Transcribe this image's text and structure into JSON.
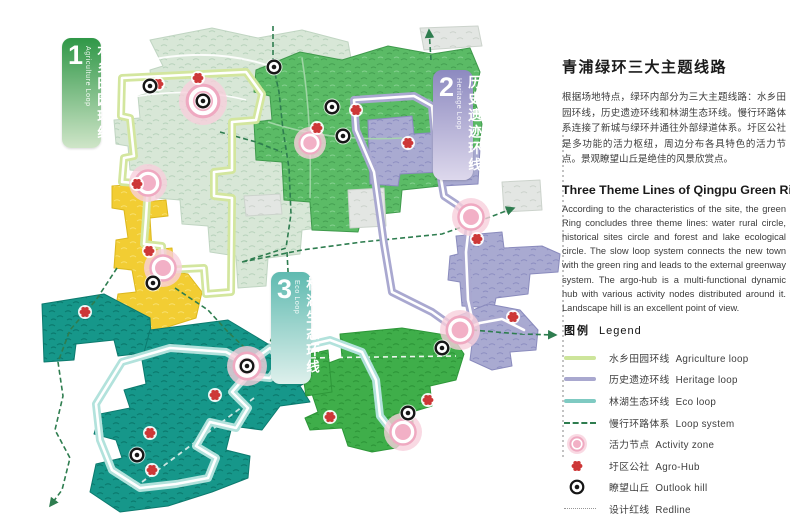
{
  "panel": {
    "title_zh": "青浦绿环三大主题线路",
    "para_zh": "根据场地特点，绿环内部分为三大主题线路：水乡田园环线，历史遗迹环线和林湖生态环线。慢行环路体系连接了新城与绿环并通往外部绿道体系。圩区公社是多功能的活力枢纽，周边分布各具特色的活力节点。景观瞭望山丘是绝佳的风景欣赏点。",
    "title_en": "Three Theme Lines of Qingpu Green Ring",
    "para_en": "According to the characteristics of the site, the green Ring concludes three theme lines: water rural circle, historical sites circle and forest and lake ecological circle. The slow loop system connects the new town with the green ring and leads to the external greenway system. The argo-hub is a multi-functional dynamic hub with various activity nodes distributed around it. Landscape hill is an excellent point of view."
  },
  "legend": {
    "header_zh": "图例",
    "header_en": "Legend",
    "items": [
      {
        "swatch": "line",
        "color": "#cde59b",
        "zh": "水乡田园环线",
        "en": "Agriculture loop"
      },
      {
        "swatch": "line",
        "color": "#a9a8cf",
        "zh": "历史遗迹环线",
        "en": "Heritage loop"
      },
      {
        "swatch": "line",
        "color": "#7fcac2",
        "zh": "林湖生态环线",
        "en": "Eco loop"
      },
      {
        "swatch": "dash",
        "color": "#2e7d4f",
        "zh": "慢行环路体系",
        "en": "Loop system"
      },
      {
        "swatch": "activity",
        "color": "#efa9c1",
        "zh": "活力节点",
        "en": "Activity zone"
      },
      {
        "swatch": "agro",
        "color": "#cd3737",
        "zh": "圩区公社",
        "en": "Agro-Hub"
      },
      {
        "swatch": "outlook",
        "color": "#161616",
        "zh": "瞭望山丘",
        "en": "Outlook hill"
      },
      {
        "swatch": "redline",
        "color": "#979797",
        "zh": "设计红线",
        "en": "Redline"
      }
    ]
  },
  "badges": [
    {
      "num": "1",
      "zh": "水乡田园环线",
      "en": "Agriculture Loop",
      "x": 62,
      "y": 38,
      "w": 39,
      "h": 110,
      "from": "#2f9747",
      "to": "#cfe5c8"
    },
    {
      "num": "2",
      "zh": "历史遗迹环线",
      "en": "Heritage Loop",
      "x": 433,
      "y": 70,
      "w": 40,
      "h": 110,
      "from": "#8d8ac0",
      "to": "#ddd8ec"
    },
    {
      "num": "3",
      "zh": "林湖生态环线",
      "en": "Eco Loop",
      "x": 271,
      "y": 272,
      "w": 40,
      "h": 112,
      "from": "#5fbab0",
      "to": "#def0ec"
    }
  ],
  "map": {
    "regions": [
      {
        "name": "farmland-pale",
        "pattern": "pale",
        "edge": "#c0d5c2",
        "path": "M150,40 L212,28 L258,38 L302,30 L348,42 L352,64 L312,62 L310,80 L346,82 L350,108 L300,104 L298,132 L332,136 L334,162 L306,164 L304,190 L332,192 L334,226 L302,230 L300,254 L268,258 L266,286 L238,288 L236,256 L210,252 L208,226 L182,224 L180,200 L156,198 L154,172 L130,170 L128,146 L116,144 L114,120 L140,118 L138,96 L152,92 L150,70 L163,66 Z"
      },
      {
        "name": "north-forest",
        "pattern": "green",
        "edge": "#3f9a4c",
        "path": "M256,70 L300,52 L342,60 L388,46 L432,54 L470,48 L480,72 L474,98 L482,124 L478,152 L442,156 L440,186 L402,190 L400,212 L362,216 L358,232 L312,230 L310,202 L284,200 L282,162 L256,160 L254,122 L272,120 L270,96 L254,92 Z"
      },
      {
        "name": "gray-urban-1",
        "pattern": "gray",
        "edge": "#ccd3cc",
        "path": "M420,28 L478,26 L482,46 L424,50 Z"
      },
      {
        "name": "gray-urban-2",
        "pattern": "gray",
        "edge": "#ccd3cc",
        "path": "M348,190 L384,188 L386,226 L350,228 Z"
      },
      {
        "name": "gray-urban-3",
        "pattern": "gray",
        "edge": "#ccd3cc",
        "path": "M502,182 L540,180 L542,210 L504,212 Z"
      },
      {
        "name": "gray-urban-4",
        "pattern": "gray",
        "edge": "#ccd3cc",
        "path": "M244,196 L280,194 L282,214 L246,216 Z"
      },
      {
        "name": "heritage-forest-a",
        "pattern": "purple",
        "edge": "#8a8bbd",
        "path": "M368,120 L412,116 L414,134 L442,132 L444,150 L480,148 L478,184 L442,186 L440,172 L400,174 L398,186 L370,184 Z"
      },
      {
        "name": "heritage-forest-b",
        "pattern": "purple",
        "edge": "#8a8bbd",
        "path": "M456,236 L502,232 L504,248 L542,246 L560,254 L558,272 L530,274 L528,294 L496,298 L494,308 L462,306 L460,282 L448,280 L450,256 L458,254 Z"
      },
      {
        "name": "heritage-forest-c",
        "pattern": "purple",
        "edge": "#8a8bbd",
        "path": "M458,316 L488,304 L520,310 L538,330 L536,350 L510,352 L512,366 L492,370 L470,360 L472,344 L456,336 Z"
      },
      {
        "name": "village-yellow",
        "pattern": "yellow",
        "edge": "#dcb81e",
        "path": "M112,186 L142,184 L144,202 L166,200 L168,216 L150,218 L152,250 L172,248 L174,272 L188,274 L202,292 L196,318 L158,330 L128,332 L114,318 L118,294 L136,292 L132,270 L114,268 L116,240 L128,238 L124,210 L112,208 Z"
      },
      {
        "name": "eco-forest-west",
        "pattern": "teal",
        "edge": "#0c7a6e",
        "path": "M42,304 L104,294 L150,318 L152,352 L118,356 L114,340 L76,344 L74,360 L44,362 Z"
      },
      {
        "name": "eco-forest-main",
        "pattern": "teal",
        "edge": "#0c7a6e",
        "path": "M150,330 L228,320 L268,344 L312,354 L326,370 L300,386 L310,402 L280,406 L262,430 L232,426 L226,450 L250,456 L248,478 L212,492 L168,506 L120,512 L90,492 L96,464 L122,458 L116,440 L94,434 L100,414 L130,408 L124,390 L146,384 L142,360 Z"
      },
      {
        "name": "south-forest",
        "pattern": "bgreen",
        "edge": "#2e9739",
        "path": "M340,334 L402,328 L452,336 L464,354 L456,380 L430,386 L432,406 L412,412 L414,432 L396,448 L372,452 L348,446 L342,428 L310,430 L305,418 L318,412 L312,394 L330,390 L326,364 L342,358 Z"
      },
      {
        "name": "south-forest-west-lobe",
        "pattern": "bgreen",
        "edge": "#2e9739",
        "path": "M300,356 L328,350 L332,392 L306,396 Z"
      }
    ],
    "roads": [
      {
        "name": "farm-road-1",
        "path": "M140,62 Q210,46 270,66",
        "color": "#ffffff",
        "width": 2
      },
      {
        "name": "farm-road-2",
        "path": "M128,98 Q190,86 246,100",
        "color": "#ffffff",
        "width": 1.6
      },
      {
        "name": "forest-road-1",
        "path": "M268,122 Q330,142 402,138",
        "color": "#a5d8ab",
        "width": 1.6
      },
      {
        "name": "forest-road-2",
        "path": "M302,58 Q312,120 310,198",
        "color": "#a5d8ab",
        "width": 1.6
      },
      {
        "name": "south-road",
        "path": "M302,358 L456,356",
        "color": "#ffffff",
        "width": 1.6,
        "dash": "5 4"
      },
      {
        "name": "eco-road",
        "path": "M142,482 L254,398",
        "color": "#dff0ec",
        "width": 1.8,
        "dash": "5 4"
      }
    ],
    "loop_system": [
      {
        "name": "slow-loop-north",
        "path": "M273,26 L273,64 L279,92 L283,130 L289,168 L291,214 L286,248 L242,262",
        "arrow": false
      },
      {
        "name": "slow-loop-east",
        "path": "M242,262 L302,250 L362,242 L442,234 L482,220 L514,208",
        "arrow": true
      },
      {
        "name": "slow-loop-branch",
        "path": "M220,132 L256,142 L282,152",
        "arrow": false
      },
      {
        "name": "slow-loop-west",
        "path": "M117,268 L96,300 L70,330 L58,362 L63,396 L55,430 L70,458 L62,490 L50,506",
        "arrow": true
      },
      {
        "name": "slow-loop-center",
        "path": "M175,288 L208,310 L228,332 L244,347",
        "arrow": false
      },
      {
        "name": "slow-loop-mid",
        "path": "M287,252 L289,290 L281,320 L269,344",
        "arrow": false
      },
      {
        "name": "slow-loop-southeast",
        "path": "M472,330 L520,334 L556,335",
        "arrow": true
      },
      {
        "name": "slow-loop-northeast",
        "path": "M431,60 L429,30",
        "arrow": true
      }
    ],
    "loops": [
      {
        "name": "agriculture-loop",
        "color": "#d3e69e",
        "path": "M122,78 L246,72 L262,94 L256,120 L232,122 L232,170 L214,172 L214,196 L232,198 L231,292 L206,294 L204,268 L164,270 L162,246 L144,244 L146,218 L148,184 L122,182 L124,158 L134,156 L130,118 L121,116 Z"
      },
      {
        "name": "heritage-loop",
        "color": "#a9a8d0",
        "path": "M354,100 L414,96 L432,106 L436,150 L444,196 L456,204 L470,216 L466,252 L468,300 L472,318 L460,332 L432,312 L392,292 L384,244 L374,172 L356,130 Z"
      },
      {
        "name": "heritage-loop-tail",
        "color": "#a9a8d0",
        "path": "M462,330 L480,323 L502,319 L524,330"
      },
      {
        "name": "eco-loop",
        "color": "#b2e2dc",
        "path": "M96,404 L122,362 L170,348 L226,352 L248,364 L270,348 L282,360 L270,378 L246,376 L232,392 L248,408 L236,428 L210,422 L196,446 L216,458 L208,478 L176,484 L140,488 L112,470 L100,440 Z"
      },
      {
        "name": "eco-loop-tail",
        "color": "#b2e2dc",
        "path": "M278,352 L330,340 L362,352 L376,380 L380,416 L394,434"
      }
    ],
    "redline": {
      "name": "design-redline",
      "path": "M563,130 L563,458",
      "color": "#9b9b9b"
    },
    "markers": {
      "activity_zones": [
        {
          "x": 203,
          "y": 101,
          "r": 24
        },
        {
          "x": 148,
          "y": 183,
          "r": 19
        },
        {
          "x": 163,
          "y": 268,
          "r": 19
        },
        {
          "x": 310,
          "y": 143,
          "r": 16
        },
        {
          "x": 471,
          "y": 217,
          "r": 19
        },
        {
          "x": 460,
          "y": 330,
          "r": 20
        },
        {
          "x": 247,
          "y": 366,
          "r": 20
        },
        {
          "x": 403,
          "y": 432,
          "r": 19
        }
      ],
      "agro_hubs": [
        [
          158,
          84
        ],
        [
          198,
          78
        ],
        [
          317,
          128
        ],
        [
          356,
          110
        ],
        [
          408,
          143
        ],
        [
          137,
          184
        ],
        [
          149,
          251
        ],
        [
          477,
          239
        ],
        [
          513,
          317
        ],
        [
          85,
          312
        ],
        [
          215,
          395
        ],
        [
          150,
          433
        ],
        [
          152,
          470
        ],
        [
          330,
          417
        ],
        [
          428,
          400
        ]
      ],
      "outlook_hills": [
        [
          150,
          86
        ],
        [
          203,
          101
        ],
        [
          274,
          67
        ],
        [
          332,
          107
        ],
        [
          343,
          136
        ],
        [
          153,
          283
        ],
        [
          247,
          366
        ],
        [
          137,
          455
        ],
        [
          442,
          348
        ],
        [
          408,
          413
        ]
      ]
    },
    "colors": {
      "loop_system": "#2e7d4f",
      "activity_halo": "#f7d0dc",
      "activity_ring": "#efa9c1",
      "activity_core": "#f2b0c6",
      "agro": "#cd3737",
      "outlook": "#161616"
    }
  }
}
